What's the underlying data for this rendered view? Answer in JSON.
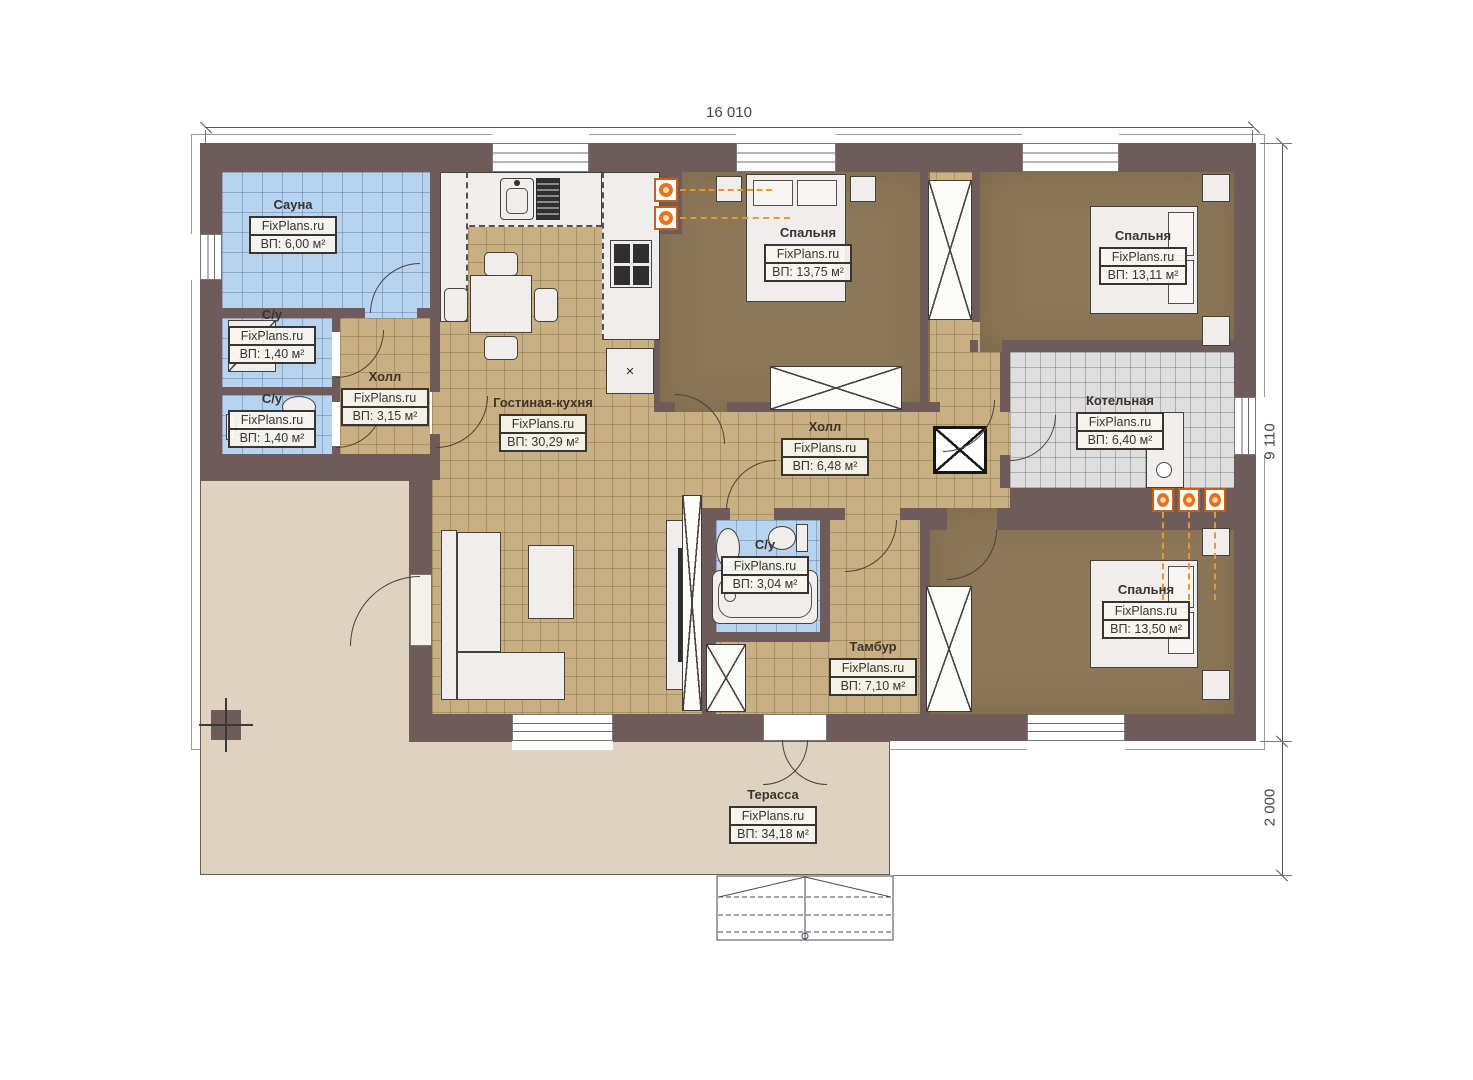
{
  "plan": {
    "watermark": "FixPlans.ru",
    "dimensions": {
      "width": "16 010",
      "height": "9 110",
      "terrace_depth": "2 000"
    },
    "rooms": [
      {
        "id": "sauna",
        "name": "Сауна",
        "area": "ВП: 6,00 м²"
      },
      {
        "id": "wc-1",
        "name": "С/у",
        "area": "ВП: 1,40 м²"
      },
      {
        "id": "wc-2",
        "name": "С/у",
        "area": "ВП: 1,40 м²"
      },
      {
        "id": "hall-1",
        "name": "Холл",
        "area": "ВП: 3,15 м²"
      },
      {
        "id": "living-kitchen",
        "name": "Гостиная-кухня",
        "area": "ВП: 30,29 м²"
      },
      {
        "id": "bedroom-1",
        "name": "Спальня",
        "area": "ВП: 13,75 м²"
      },
      {
        "id": "bedroom-2",
        "name": "Спальня",
        "area": "ВП: 13,11 м²"
      },
      {
        "id": "hall-2",
        "name": "Холл",
        "area": "ВП: 6,48 м²"
      },
      {
        "id": "boiler",
        "name": "Котельная",
        "area": "ВП: 6,40 м²"
      },
      {
        "id": "wc-3",
        "name": "С/у",
        "area": "ВП: 3,04 м²"
      },
      {
        "id": "vestibule",
        "name": "Тамбур",
        "area": "ВП: 7,10 м²"
      },
      {
        "id": "bedroom-3",
        "name": "Спальня",
        "area": "ВП: 13,50 м²"
      },
      {
        "id": "terrace",
        "name": "Терасса",
        "area": "ВП: 34,18 м²"
      }
    ],
    "symbols": {
      "appliance_x": "×"
    },
    "colors": {
      "wall": "#6f5b5a",
      "floor_tile_tan": "#c8b083",
      "floor_tile_blue": "#b7d3ef",
      "floor_tile_gray": "#dedede",
      "floor_bedroom": "#8c7758",
      "terrace": "#ded2c0",
      "radiator_orange": "#e8731f",
      "label_text": "#3a332e"
    }
  }
}
